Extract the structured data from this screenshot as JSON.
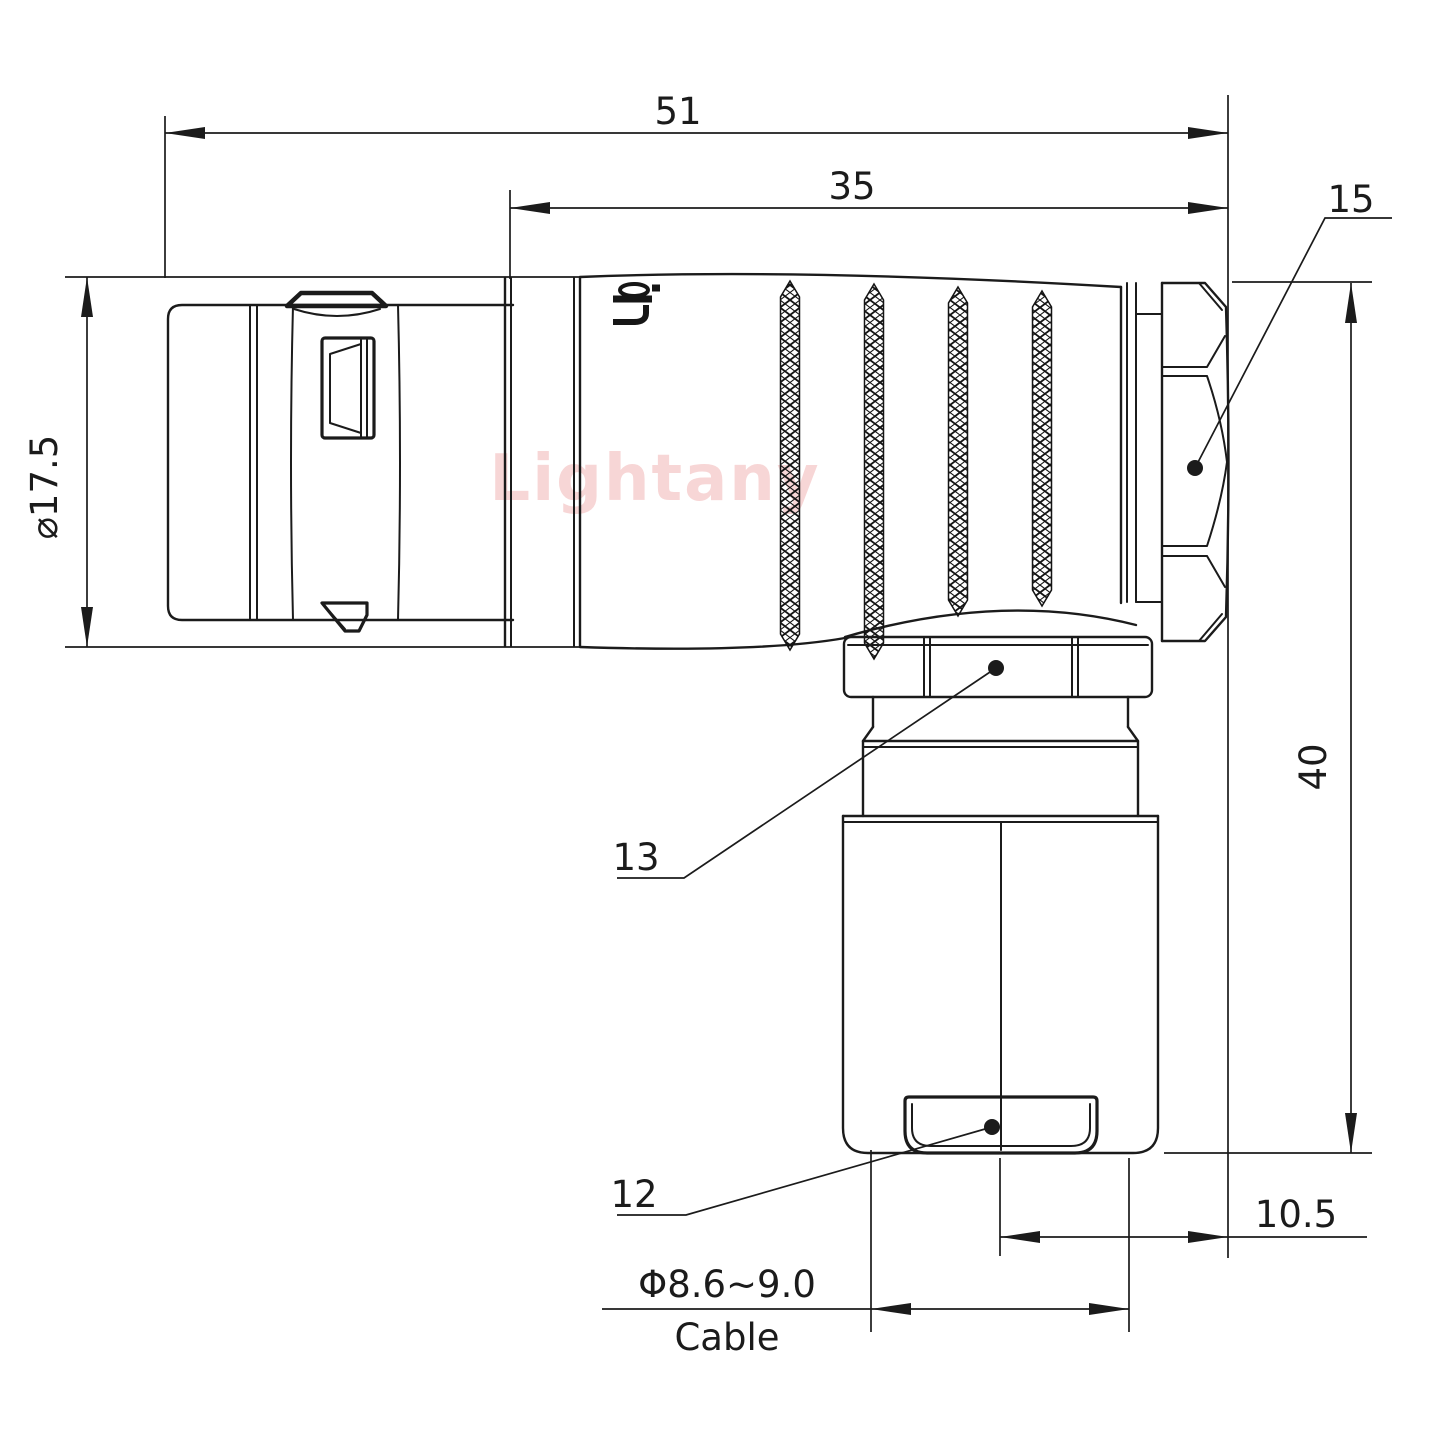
{
  "meta": {
    "background_color": "#ffffff",
    "line_color": "#1b1b1b",
    "watermark_color": "#f6cccc"
  },
  "watermark": {
    "text": "Lightany"
  },
  "body_logo": {
    "icon": "lightany-logo-mark",
    "text": "Lig"
  },
  "dimensions": {
    "overall_length": "51",
    "boot_length": "35",
    "shell_diameter": "⌀17.5",
    "elbow_height": "40",
    "nut_offset": "10.5",
    "cable_diameter": "Φ8.6~9.0",
    "cable_label": "Cable"
  },
  "part_labels": {
    "back_nut": "15",
    "gland_nut": "13",
    "sleeve_window": "12"
  }
}
